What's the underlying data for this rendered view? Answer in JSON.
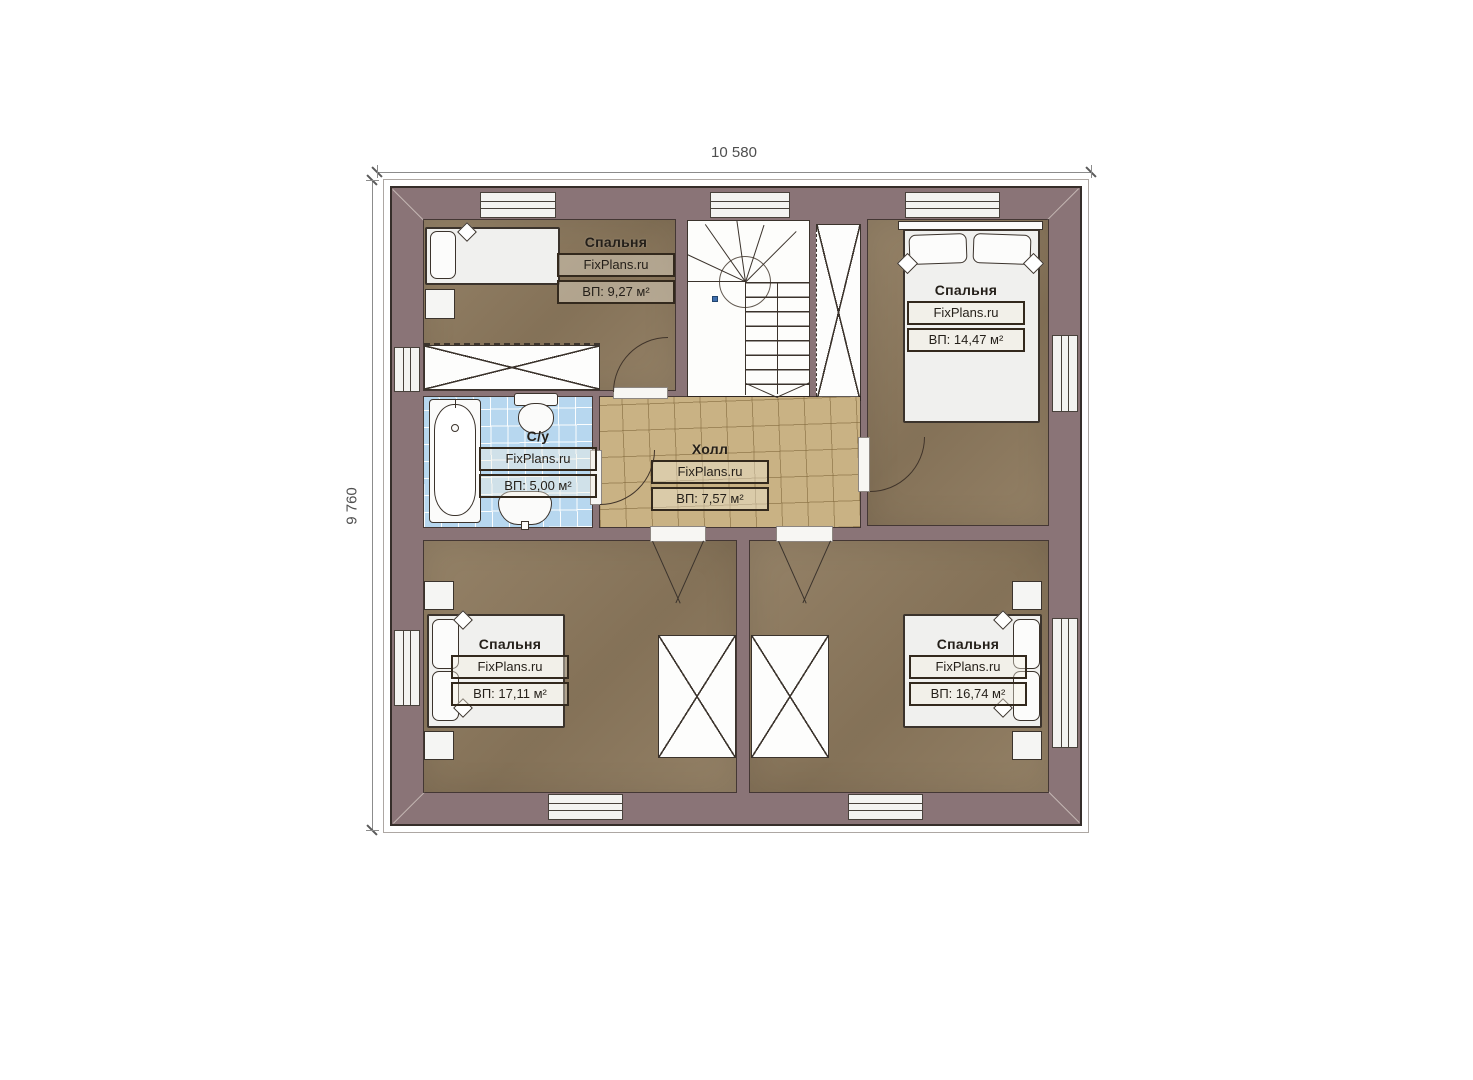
{
  "plan": {
    "title": "floor-plan",
    "dimensions": {
      "width_label": "10 580",
      "height_label": "9 760"
    },
    "rooms": {
      "bedroom_tl": {
        "name": "Спальня",
        "brand": "FixPlans.ru",
        "area": "ВП: 9,27 м²"
      },
      "bedroom_tr": {
        "name": "Спальня",
        "brand": "FixPlans.ru",
        "area": "ВП: 14,47 м²"
      },
      "bathroom": {
        "name": "С/у",
        "brand": "FixPlans.ru",
        "area": "ВП: 5,00 м²"
      },
      "hall": {
        "name": "Холл",
        "brand": "FixPlans.ru",
        "area": "ВП: 7,57 м²"
      },
      "bedroom_bl": {
        "name": "Спальня",
        "brand": "FixPlans.ru",
        "area": "ВП: 17,11 м²"
      },
      "bedroom_br": {
        "name": "Спальня",
        "brand": "FixPlans.ru",
        "area": "ВП: 16,74 м²"
      }
    },
    "colors": {
      "wall": "#8a7477",
      "wall_line": "#362e2a",
      "floor": "#8e7a5e",
      "hall_tile": "#c9b284",
      "bath_tile": "#b7d7ef",
      "object_line": "#3b332c",
      "label_border": "#33291d",
      "text": "#241f19",
      "dim": "#4f4f4f",
      "accent_dot": "#3f6fae"
    }
  }
}
